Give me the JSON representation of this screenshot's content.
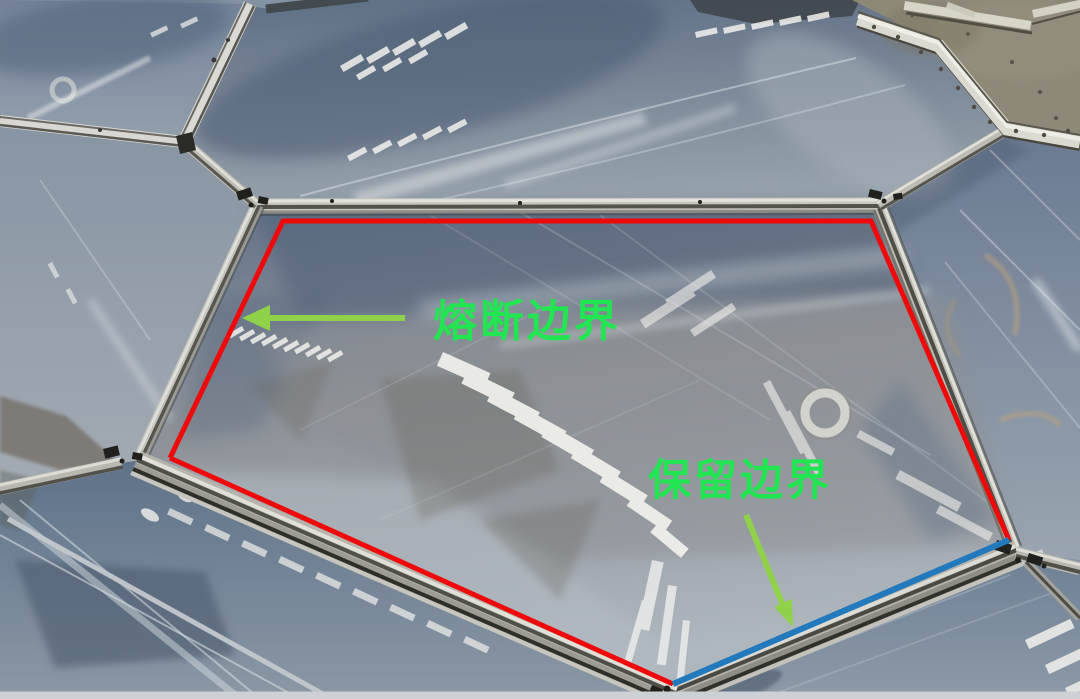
{
  "photo": {
    "subject": "ETFE cushion membrane roof panels with aluminum frame profiles photographed at an angle; a central pentagonal panel is outlined by annotation lines",
    "bottom_strip_color": "#cdd1d5"
  },
  "annotations": {
    "fuse_boundary": {
      "label": "熔断边界",
      "color": "#ee0a0a"
    },
    "keep_boundary": {
      "label": "保留边界",
      "color": "#2279bb"
    },
    "label_color": "#22e552",
    "arrow_color": "#8fd24a"
  }
}
